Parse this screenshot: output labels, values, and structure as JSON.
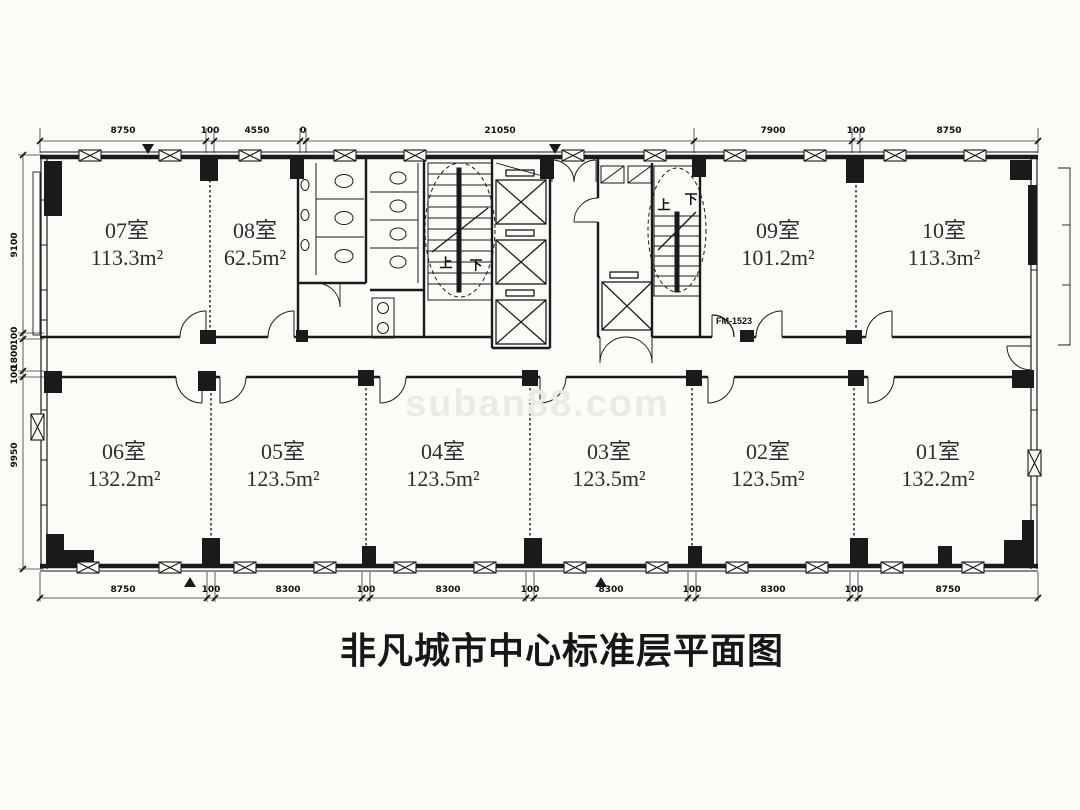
{
  "title": "非凡城市中心标准层平面图",
  "watermark": "suban88.com",
  "rooms": {
    "top": [
      {
        "name": "07室",
        "area": "113.3m²"
      },
      {
        "name": "08室",
        "area": "62.5m²"
      },
      {
        "name": "09室",
        "area": "101.2m²"
      },
      {
        "name": "10室",
        "area": "113.3m²"
      }
    ],
    "bottom": [
      {
        "name": "06室",
        "area": "132.2m²"
      },
      {
        "name": "05室",
        "area": "123.5m²"
      },
      {
        "name": "04室",
        "area": "123.5m²"
      },
      {
        "name": "03室",
        "area": "123.5m²"
      },
      {
        "name": "02室",
        "area": "123.5m²"
      },
      {
        "name": "01室",
        "area": "132.2m²"
      }
    ]
  },
  "stairs": {
    "up": "上",
    "down": "下"
  },
  "door_label": "FM-1523",
  "dimensions": {
    "top": [
      "8750",
      "100",
      "4550",
      "0",
      "21050",
      "7900",
      "100",
      "8750"
    ],
    "bottom": [
      "8750",
      "100",
      "8300",
      "100",
      "8300",
      "100",
      "8300",
      "100",
      "8300",
      "100",
      "8750"
    ],
    "left": [
      "9100",
      "100",
      "1800",
      "100",
      "9950"
    ]
  },
  "colors": {
    "line": "#1a1a1a",
    "background": "#fcfbf8",
    "watermark_gray": "#ebeae7"
  }
}
